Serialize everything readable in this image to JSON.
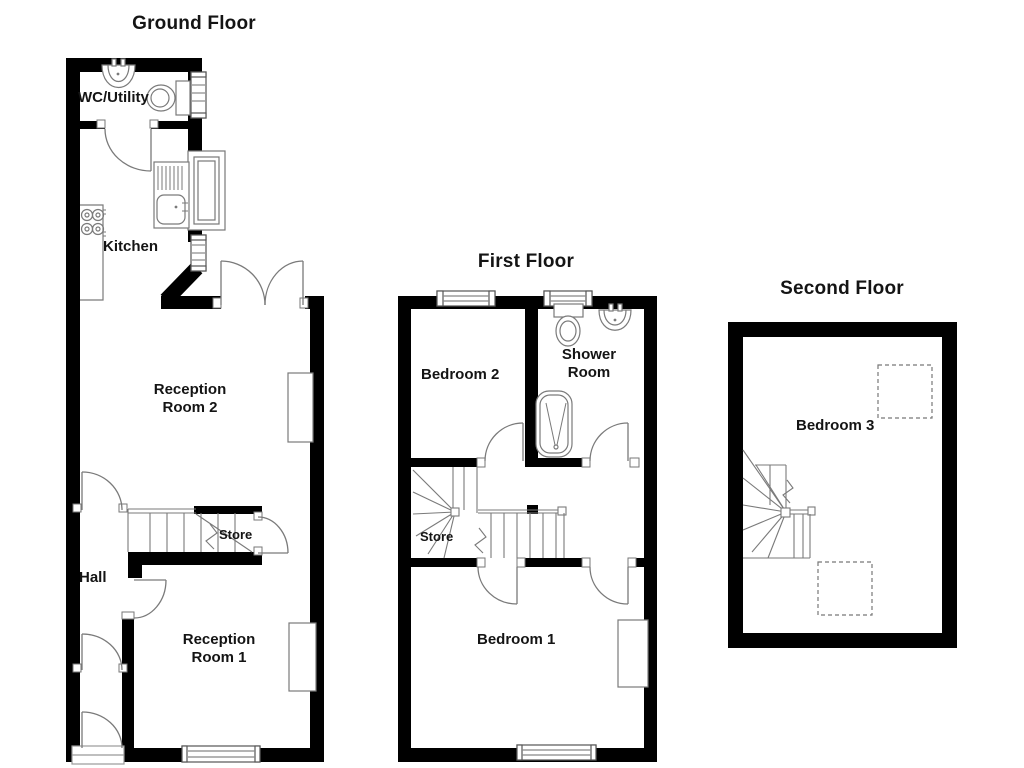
{
  "document": {
    "type": "floorplan",
    "background_color": "#ffffff",
    "wall_color": "#000000",
    "fixture_line_color": "#7a7a7a",
    "text_color": "#141414"
  },
  "floors": {
    "ground": {
      "title": "Ground Floor",
      "rooms": {
        "wc_utility": "WC/Utility",
        "kitchen": "Kitchen",
        "reception_2": "Reception Room 2",
        "hall": "Hall",
        "store": "Store",
        "reception_1": "Reception Room 1"
      },
      "fixtures": [
        "basin",
        "toilet",
        "kitchen-sink",
        "hob",
        "counter",
        "stairs",
        "french-doors",
        "windows"
      ]
    },
    "first": {
      "title": "First Floor",
      "rooms": {
        "bedroom_2": "Bedroom 2",
        "shower_room": "Shower Room",
        "store": "Store",
        "bedroom_1": "Bedroom 1"
      },
      "fixtures": [
        "toilet",
        "basin",
        "shower",
        "stairs",
        "wardrobe",
        "windows"
      ]
    },
    "second": {
      "title": "Second Floor",
      "rooms": {
        "bedroom_3": "Bedroom 3"
      },
      "fixtures": [
        "stairs",
        "restricted-head-height-dashed-areas"
      ]
    }
  }
}
